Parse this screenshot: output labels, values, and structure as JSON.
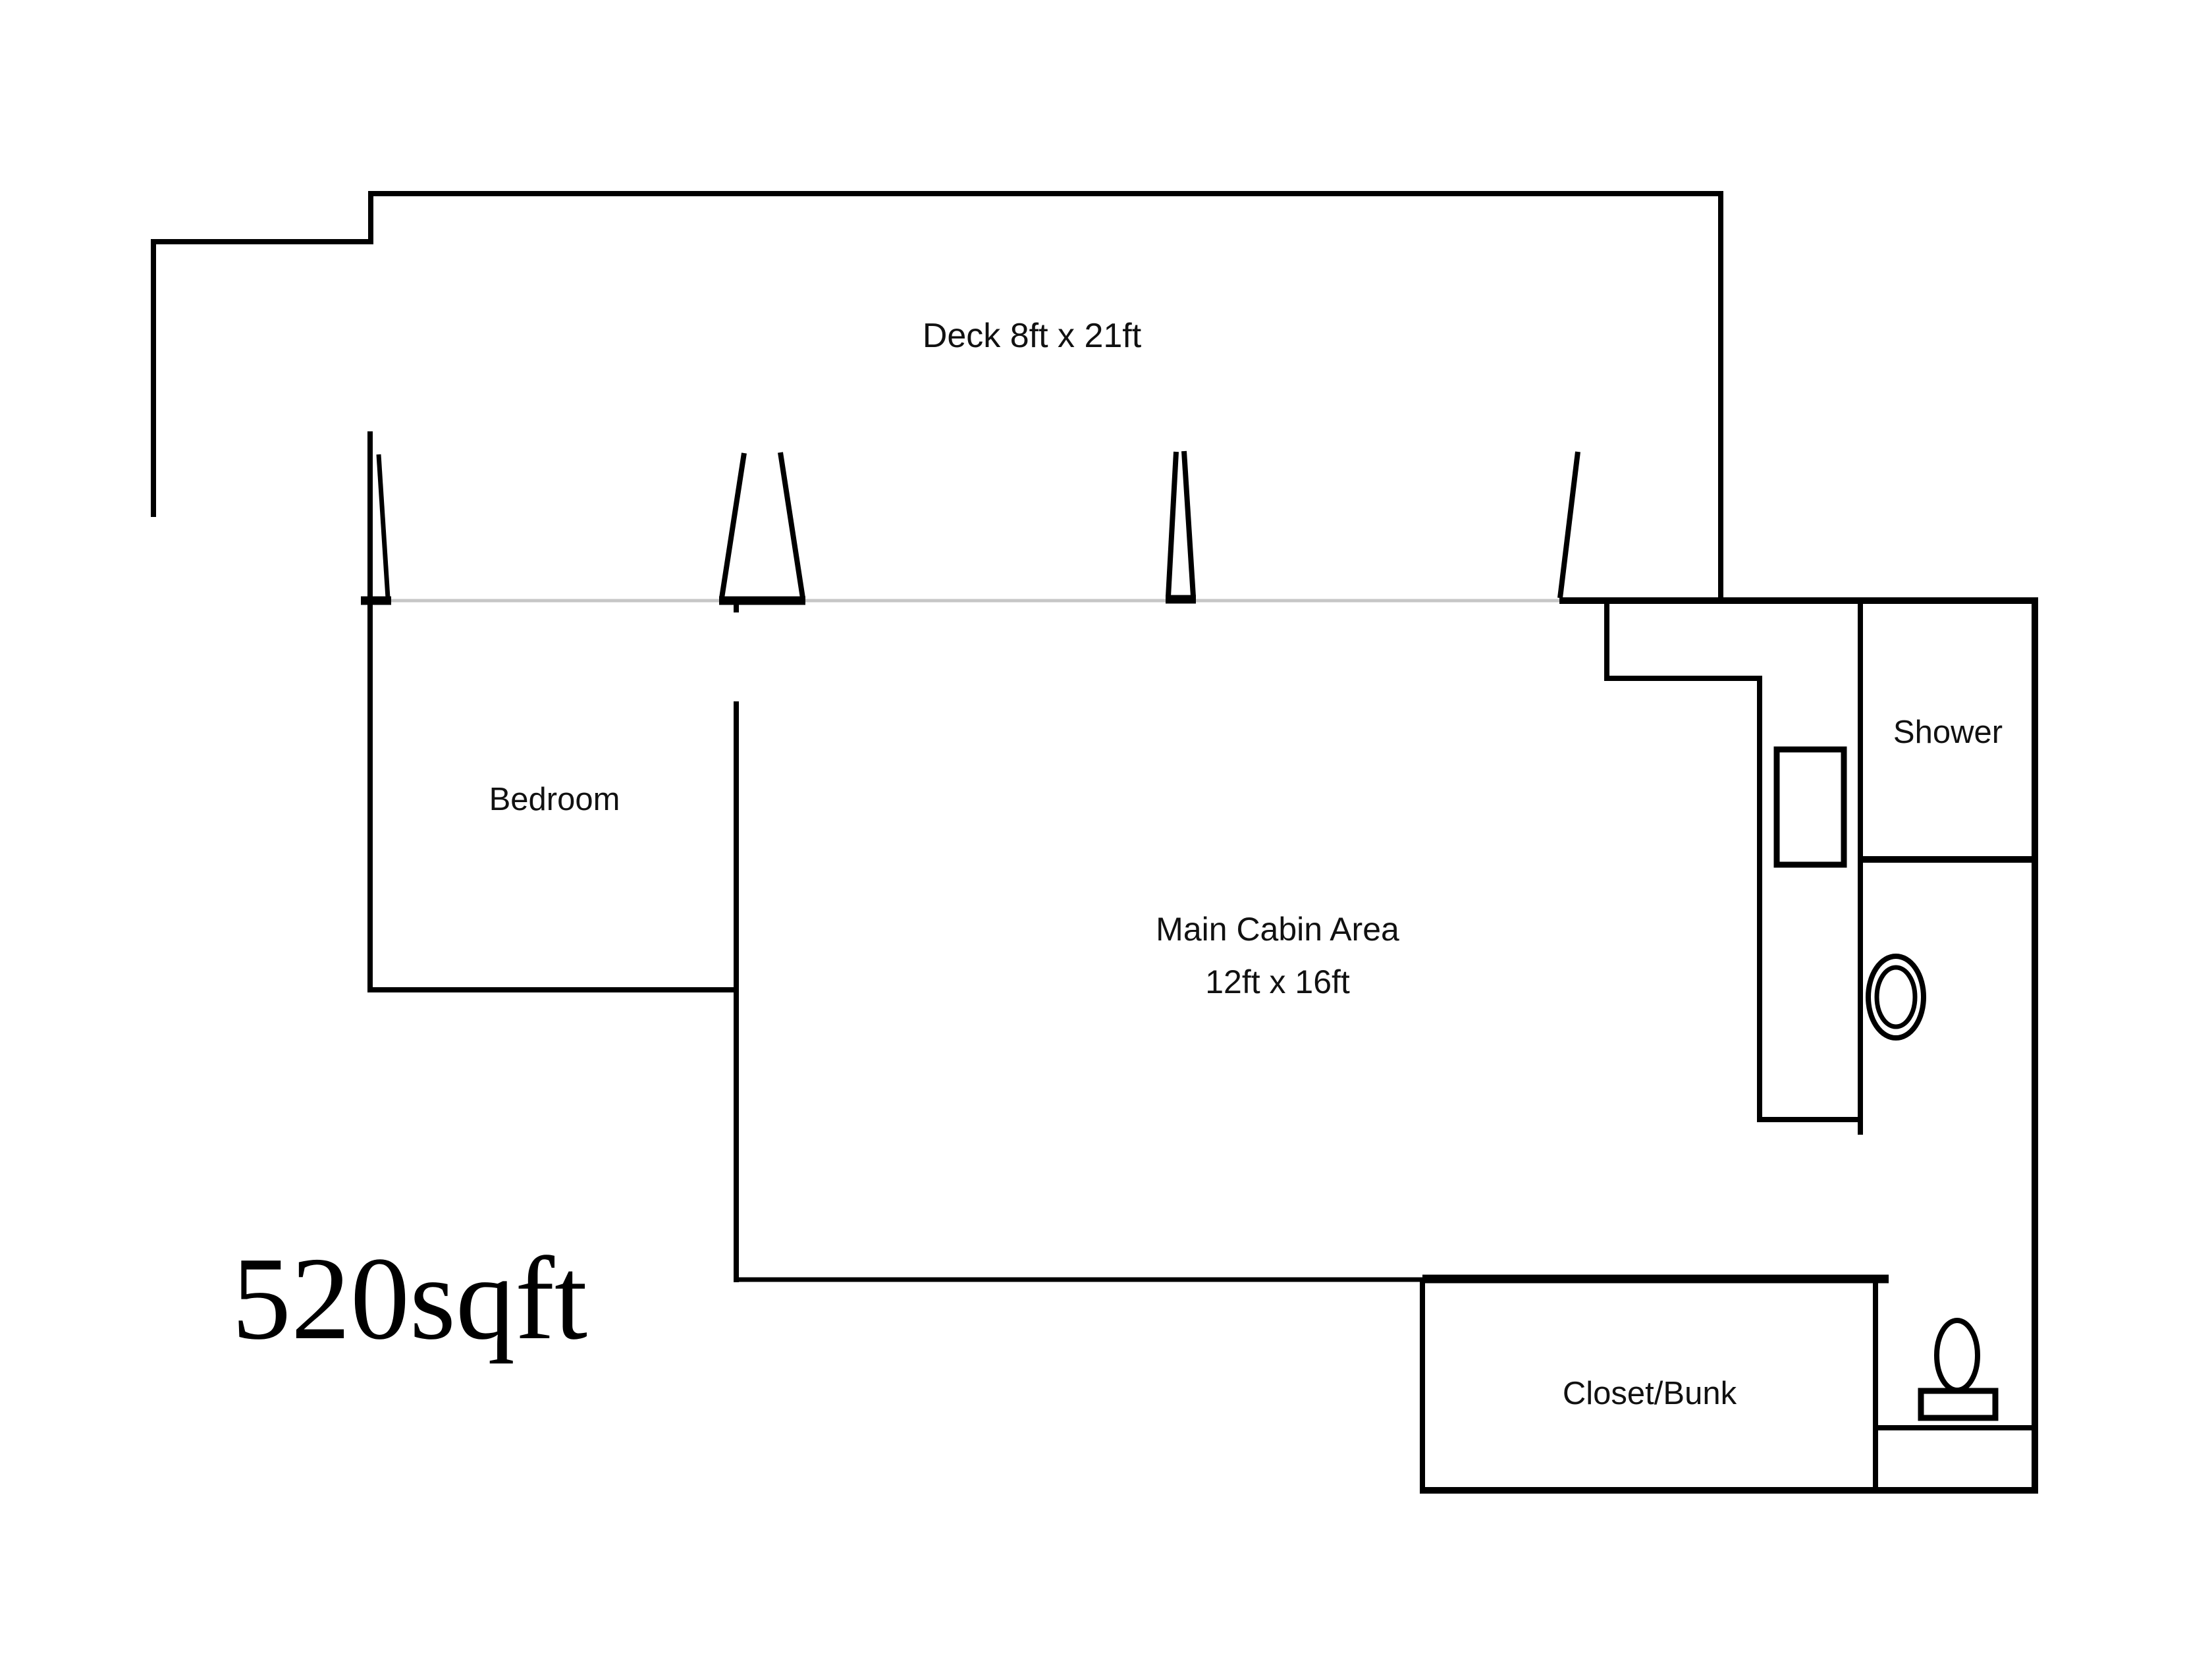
{
  "plan": {
    "title": "Cabin floor plan",
    "total_area_label": "520sqft",
    "rooms": {
      "deck": {
        "label": "Deck 8ft x 21ft"
      },
      "bedroom": {
        "label": "Bedroom"
      },
      "main_cabin": {
        "label": "Main Cabin Area",
        "dimensions_label": "12ft x 16ft"
      },
      "shower": {
        "label": "Shower"
      },
      "closet_bunk": {
        "label": "Closet/Bunk"
      }
    },
    "fixtures": [
      {
        "name": "counter-appliance-rect"
      },
      {
        "name": "sink-oval"
      },
      {
        "name": "toilet-bowl-and-tank"
      }
    ],
    "colors": {
      "walls": "#000000",
      "deck_edge_line": "#c6c6c6",
      "label_text": "#111111",
      "background": "#ffffff"
    }
  }
}
